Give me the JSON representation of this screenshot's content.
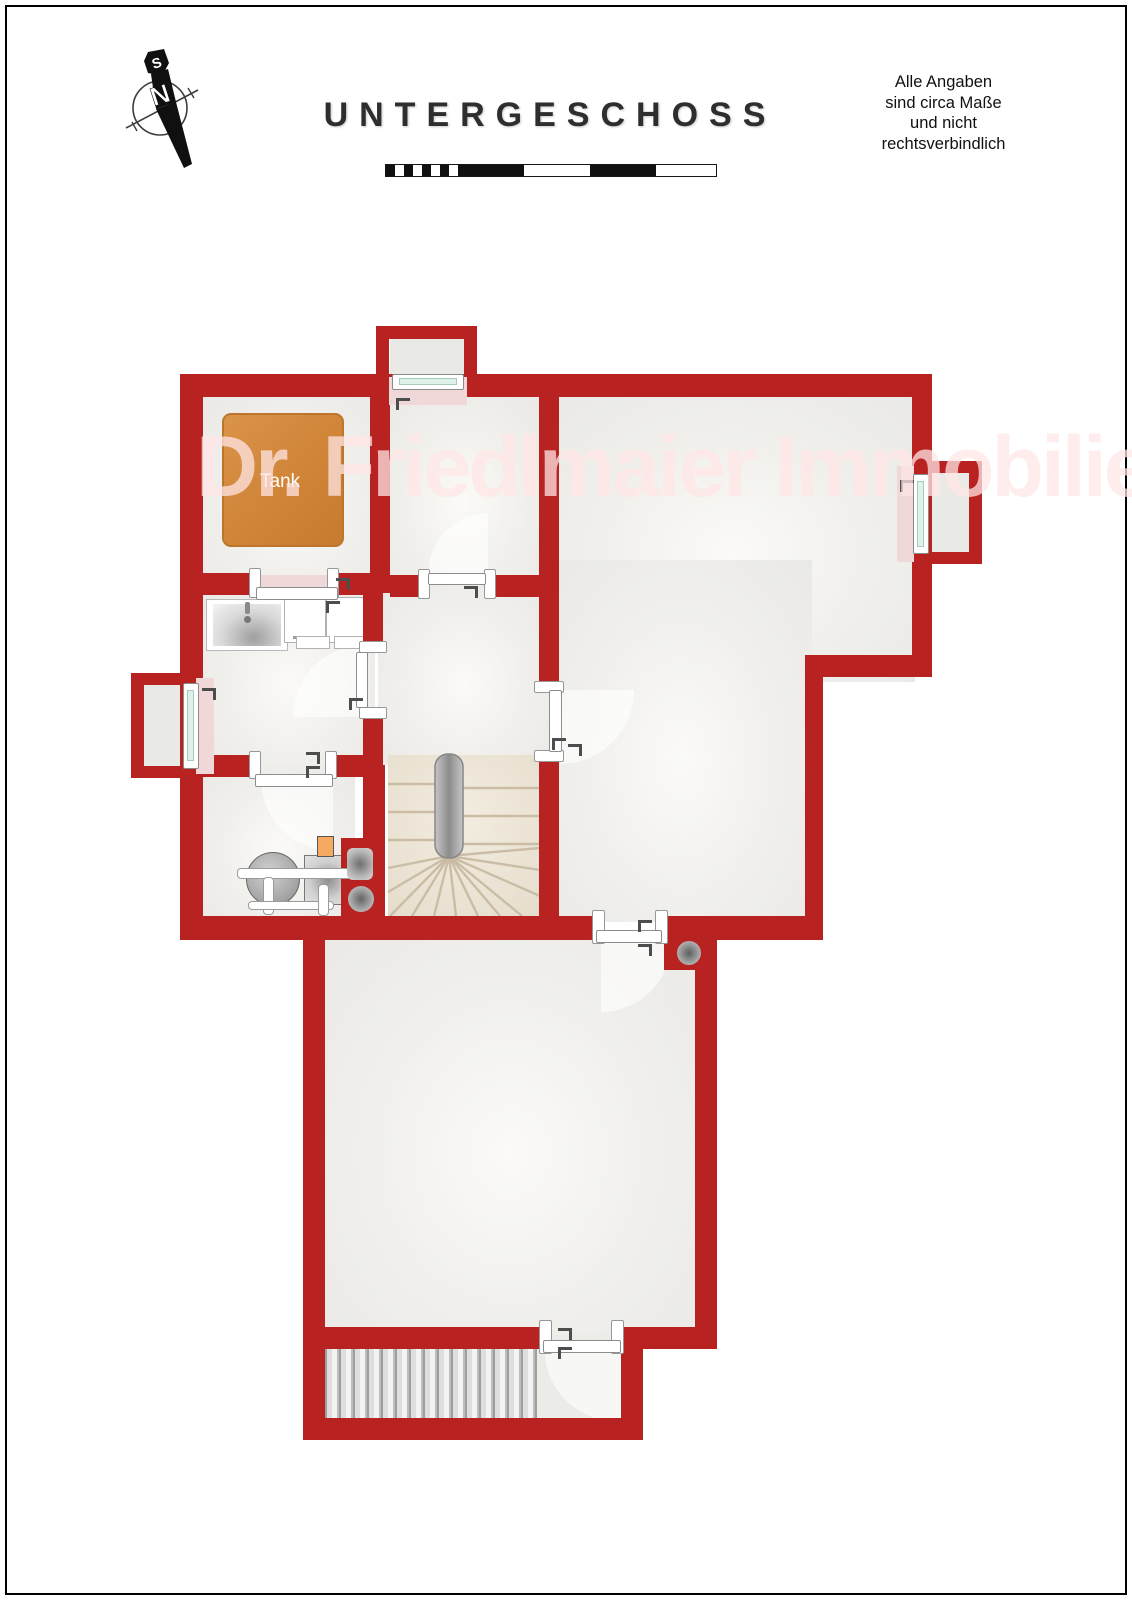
{
  "header": {
    "title": "UNTERGESCHOSS",
    "disclaimer_lines": [
      "Alle Angaben",
      "sind circa Maße",
      "und nicht",
      "rechtsverbindlich"
    ]
  },
  "compass": {
    "south": "S",
    "north": "N"
  },
  "watermark": {
    "text": "Dr. Friedlmaier Immobilien"
  },
  "plan": {
    "labels": {
      "tank": "Tank"
    },
    "colors": {
      "wall_red": "#B82321",
      "room_fill": "#EFEEEA",
      "tank_orange": "#D2873D",
      "window_sill_pink": "#F0D8D8",
      "window_glass_mint": "#DFF2EA",
      "stairs_interior_beige": "#EAE2D3",
      "stairs_exterior_gray": "#D9D9D9",
      "door_white": "#FFFFFF"
    }
  }
}
